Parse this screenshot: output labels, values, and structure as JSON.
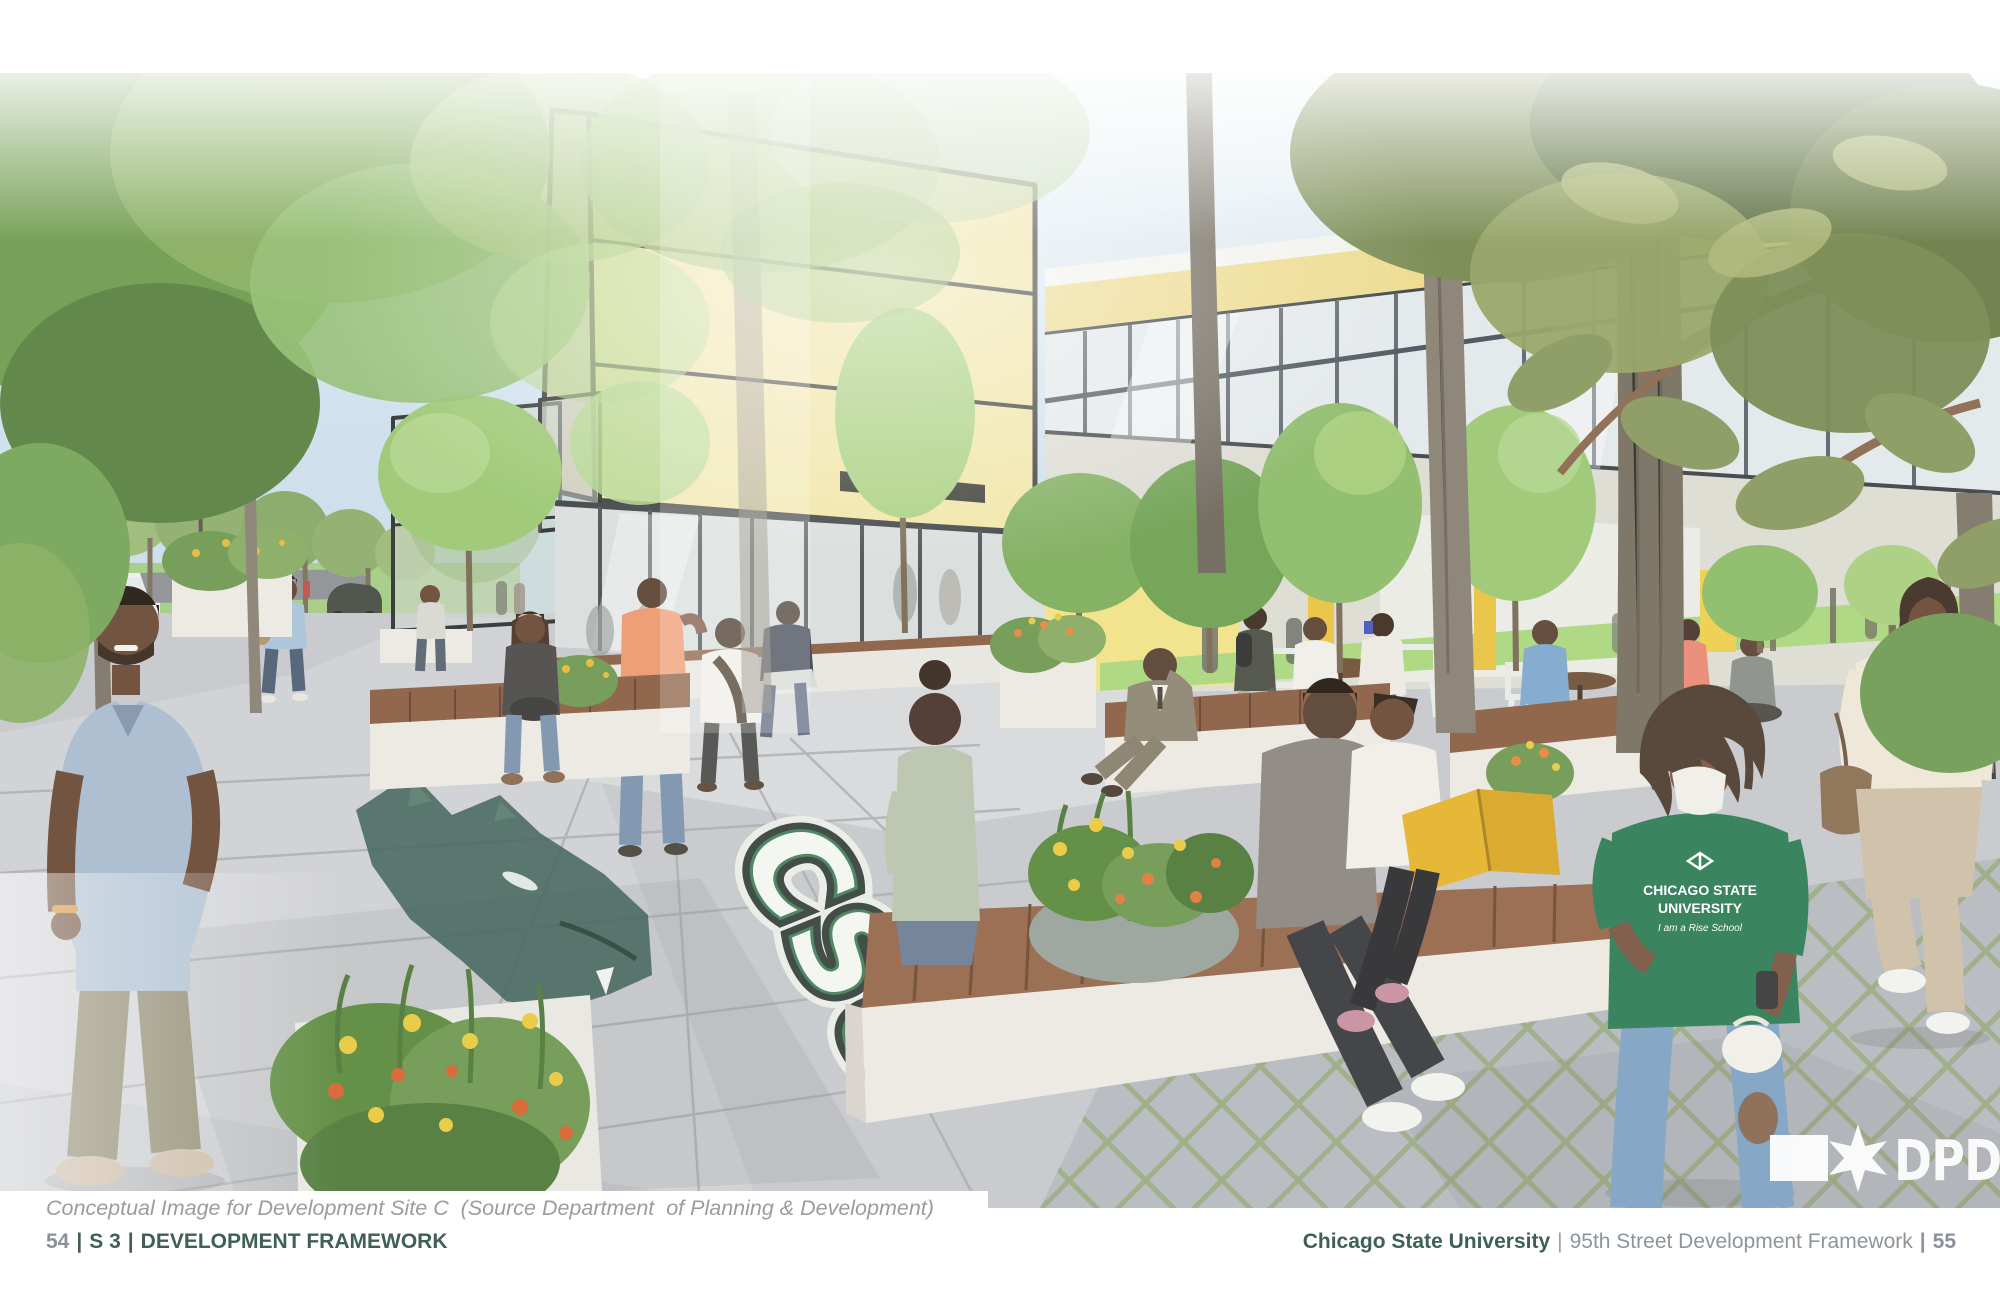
{
  "caption": {
    "text": "Conceptual Image for Development Site C  (Source Department  of Planning & Development)"
  },
  "footer_left": {
    "page_number": "54",
    "separator": "|",
    "section": "S 3",
    "title": "DEVELOPMENT FRAMEWORK"
  },
  "footer_right": {
    "university": "Chicago State University",
    "separator": "|",
    "framework_title": "95th Street Development Framework",
    "page_number": "55"
  },
  "rendering": {
    "description": "Conceptual rendering of a landscaped campus plaza with wood benches, planters, trees and yellow mixed-use buildings for Development Site C",
    "ground_logo": {
      "text": "CSU"
    },
    "mascot": "cougar-head-ground-painting",
    "dpd_logo": {
      "text": "DPD"
    },
    "tshirt": {
      "line1": "CHICAGO STATE",
      "line2": "UNIVERSITY",
      "line3": "I am a Rise School"
    },
    "colors": {
      "brand_green": "#3f6054",
      "building_yellow": "#f1e5a6",
      "fascia_yellow": "#eeda8c",
      "csu_logo_green": "#3e6156",
      "sky_blue": "#c8dbe8",
      "pavement_gray": "#c3c5c9",
      "bench_wood": "#8b5e42",
      "lawn_green": "#a9d77d"
    }
  }
}
